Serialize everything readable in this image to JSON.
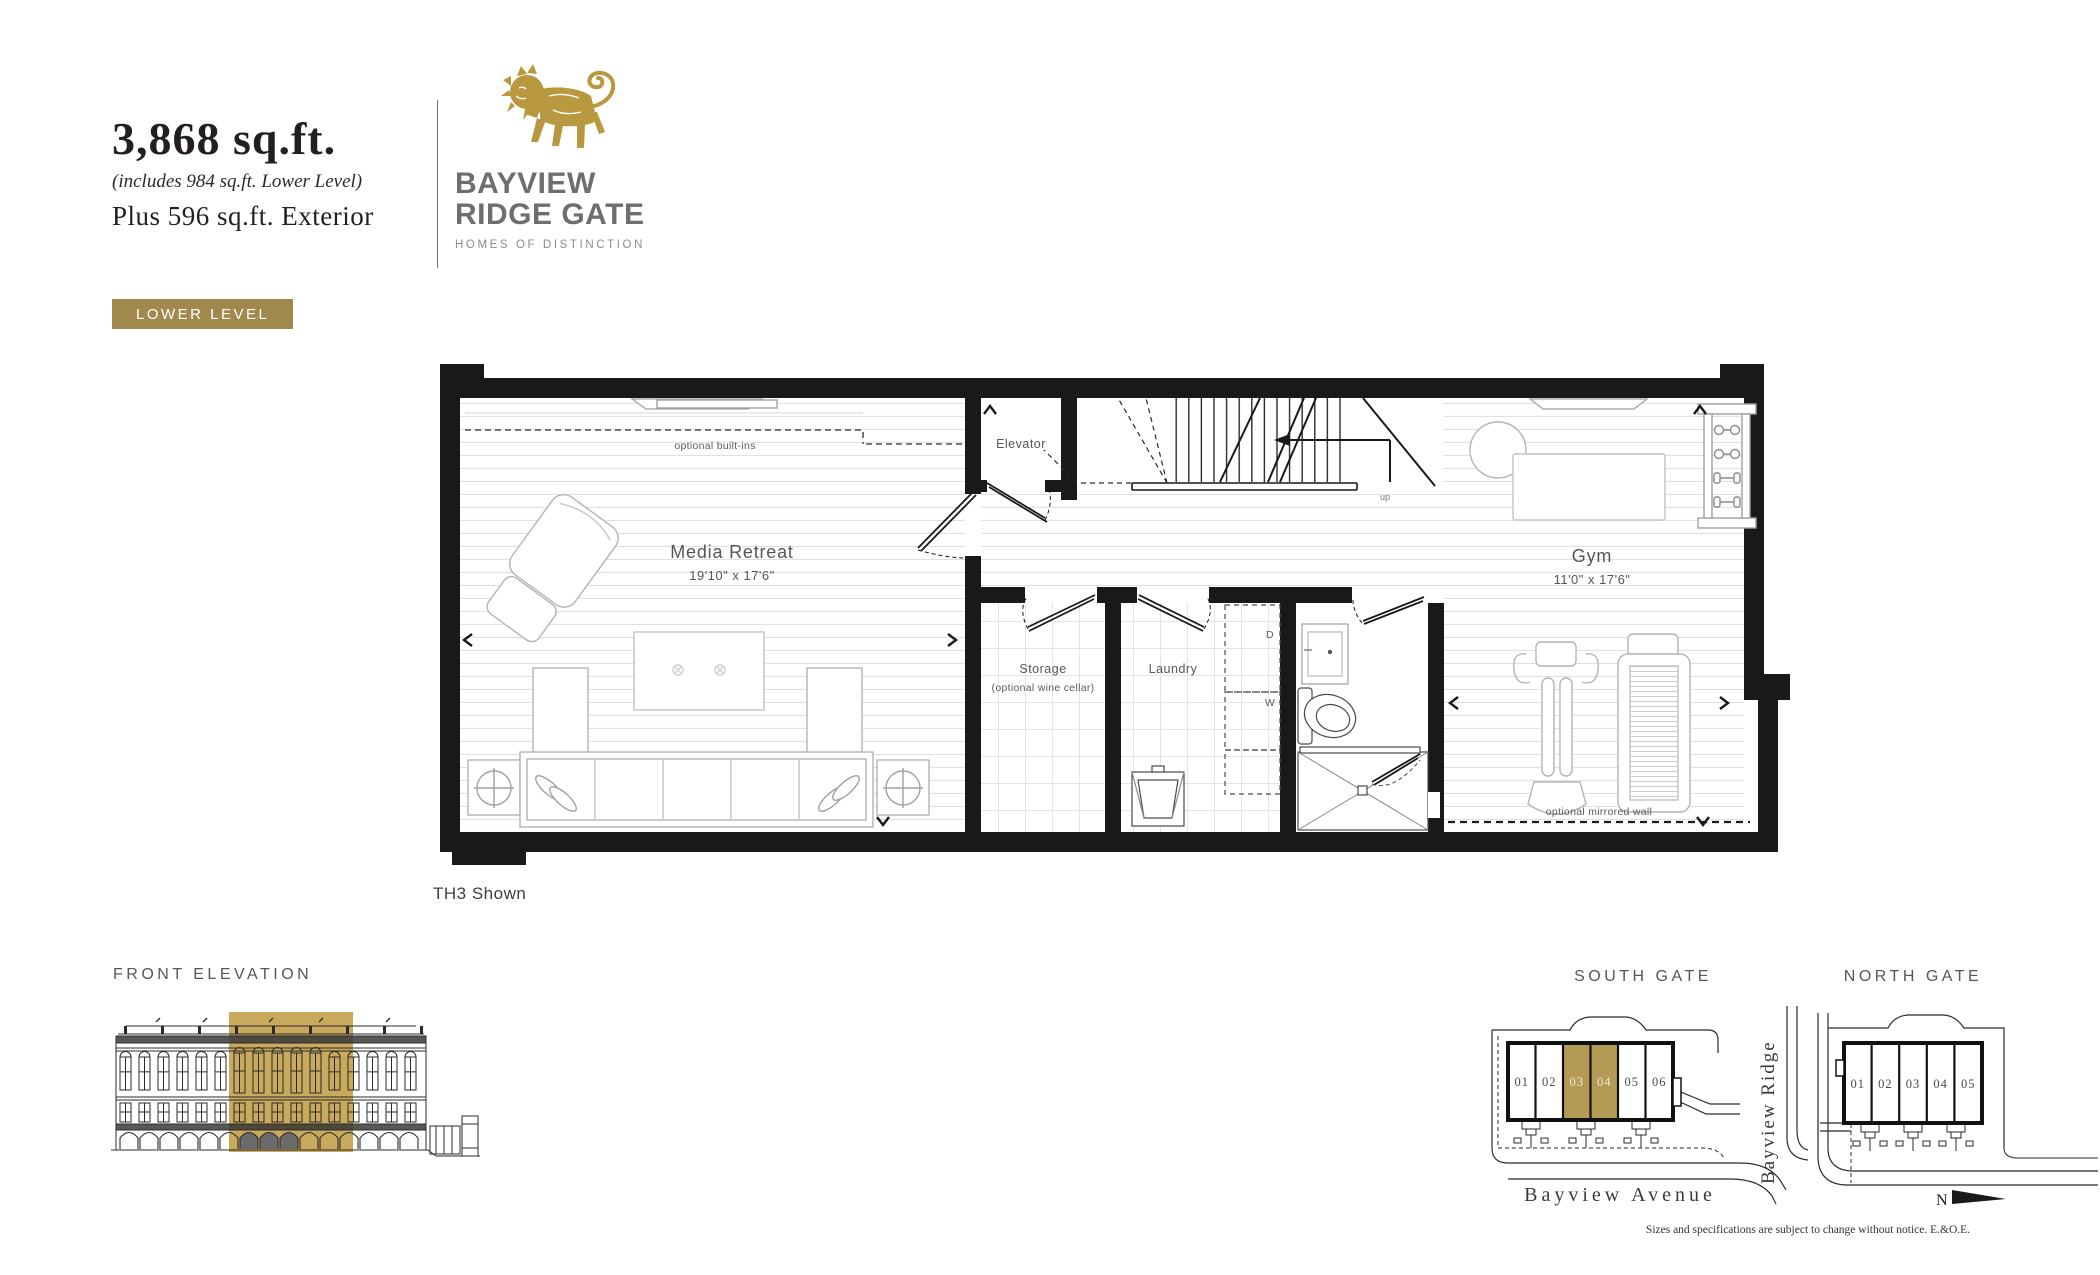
{
  "header": {
    "area": "3,868 sq.ft.",
    "area_note": "(includes 984 sq.ft. Lower Level)",
    "exterior": "Plus 596 sq.ft. Exterior",
    "badge": "LOWER LEVEL"
  },
  "brand": {
    "line1": "BAYVIEW",
    "line2": "RIDGE GATE",
    "tagline": "HOMES OF DISTINCTION",
    "gold": "#b8993f",
    "gray": "#6d6e71",
    "lion_icon": "lion-crest"
  },
  "plan": {
    "shown": "TH3 Shown",
    "media": {
      "name": "Media Retreat",
      "dims": "19'10\" x 17'6\""
    },
    "gym": {
      "name": "Gym",
      "dims": "11'0\" x 17'6\""
    },
    "elevator": "Elevator",
    "storage": "Storage",
    "storage_note": "(optional wine cellar)",
    "laundry": "Laundry",
    "dryer": "D",
    "washer": "W",
    "up": "up",
    "builtins": "optional built-ins",
    "mirror": "optional mirrored wall"
  },
  "elevation": {
    "label": "FRONT ELEVATION",
    "highlight": "#c9aa5c"
  },
  "site": {
    "south": {
      "label": "SOUTH GATE",
      "units": [
        "01",
        "02",
        "03",
        "04",
        "05",
        "06"
      ],
      "highlighted": [
        "03",
        "04"
      ]
    },
    "north": {
      "label": "NORTH GATE",
      "units": [
        "01",
        "02",
        "03",
        "04",
        "05"
      ]
    },
    "street_vertical": "Bayview Ridge",
    "street_horizontal": "Bayview Avenue",
    "compass": "N",
    "highlight": "#b39a55",
    "disclaimer": "Sizes and specifications are subject to change without notice. E.&O.E."
  }
}
